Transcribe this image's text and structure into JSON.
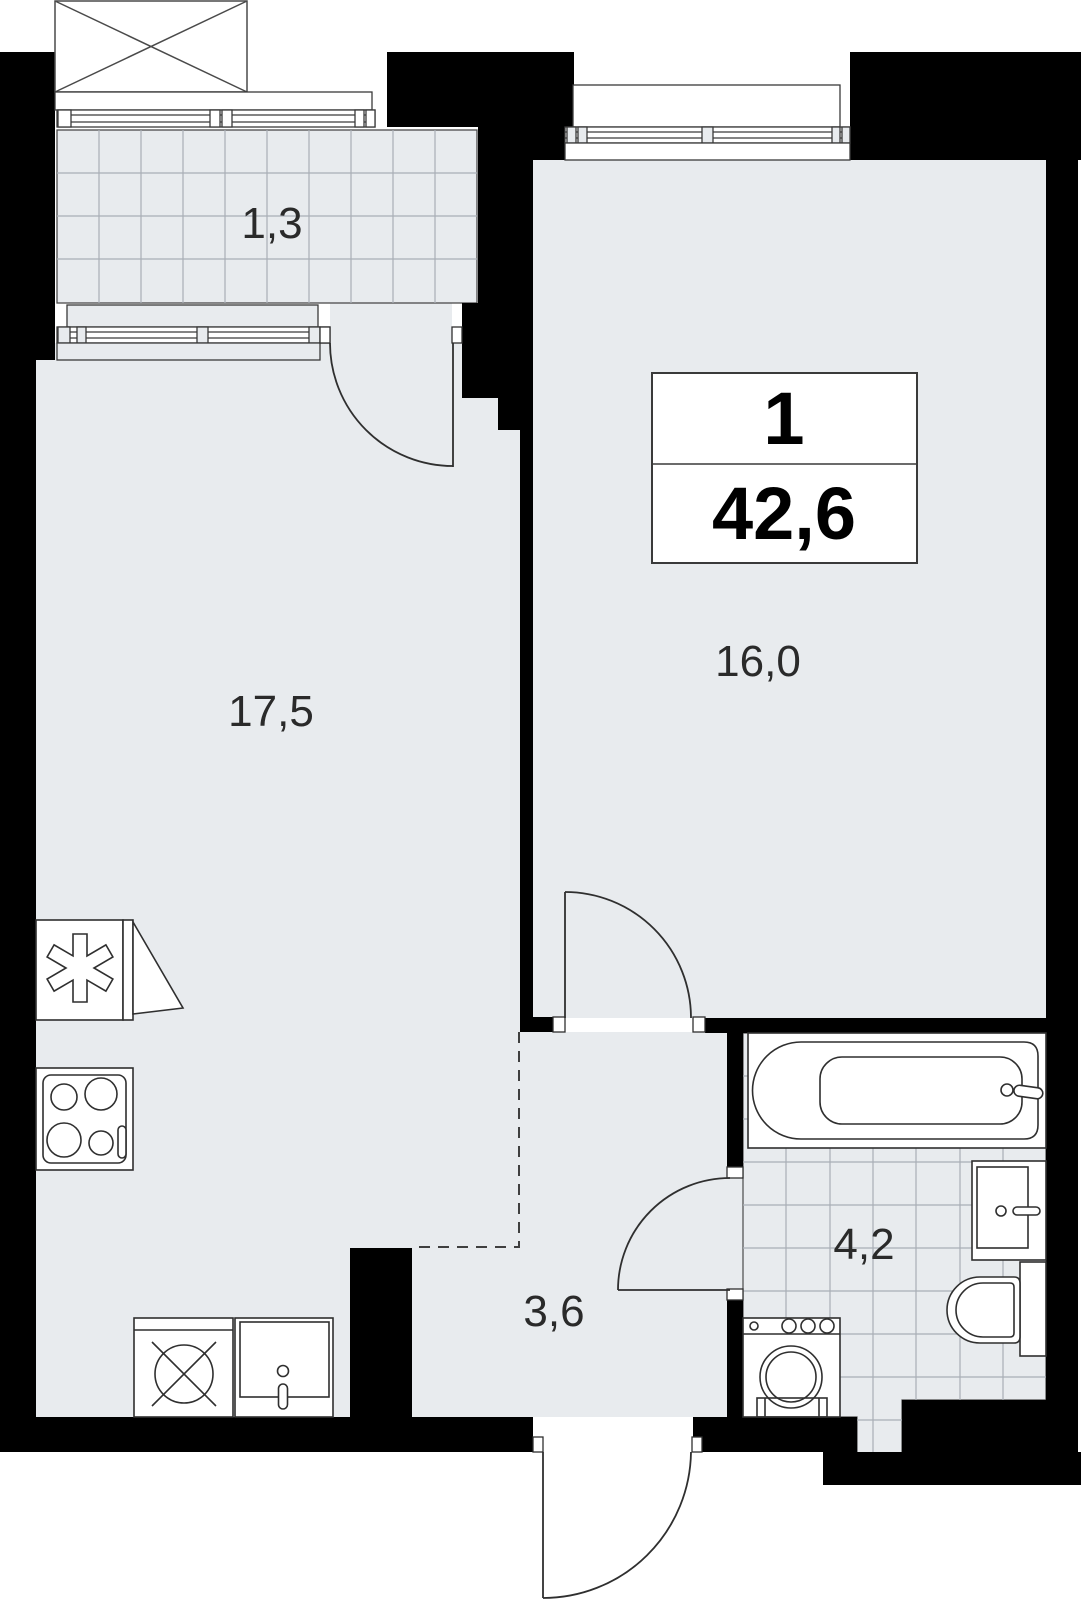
{
  "plan": {
    "info_box": {
      "rooms_count": "1",
      "total_area": "42,6"
    },
    "rooms": {
      "balcony": {
        "area": "1,3"
      },
      "kitchen_living": {
        "area": "17,5"
      },
      "bedroom": {
        "area": "16,0"
      },
      "hallway": {
        "area": "3,6"
      },
      "bathroom": {
        "area": "4,2"
      }
    },
    "fixtures": [
      "fridge",
      "stove",
      "dishwasher",
      "kitchen-sink",
      "bathtub",
      "washbasin",
      "toilet",
      "washing-machine"
    ],
    "colors": {
      "wall": "#000000",
      "floor": "#e8ebee",
      "tile_line": "#a9aeb6",
      "outline": "#2f2f2f"
    }
  }
}
